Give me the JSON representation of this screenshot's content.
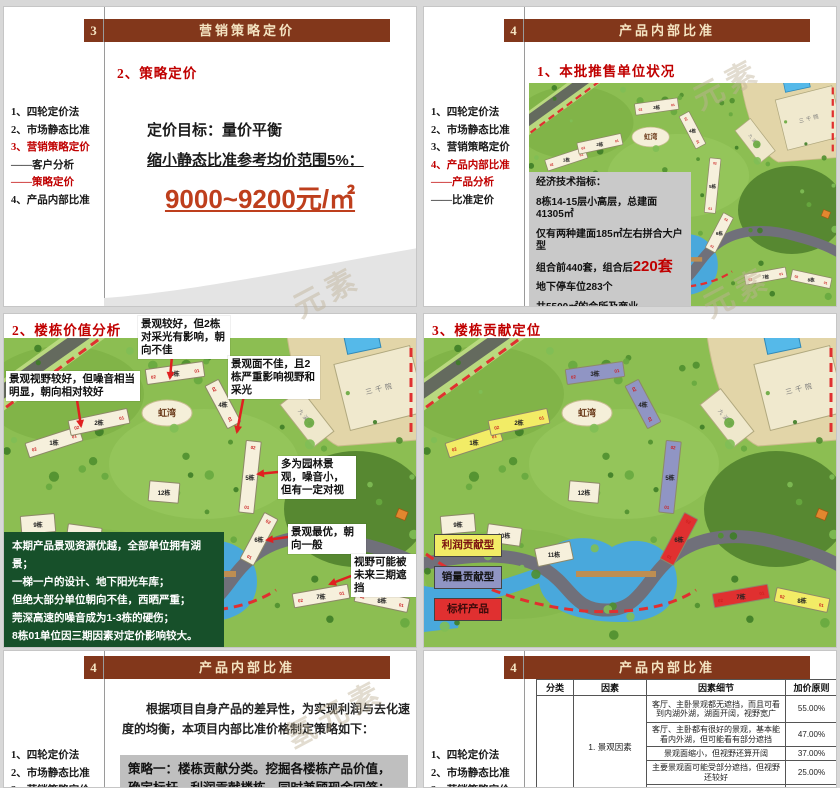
{
  "watermarks": [
    {
      "text": "元素",
      "x": 290,
      "y": 268
    },
    {
      "text": "元素",
      "x": 700,
      "y": 268
    },
    {
      "text": "氢元素",
      "x": 280,
      "y": 690
    },
    {
      "text": "元素",
      "x": 690,
      "y": 60
    }
  ],
  "s1": {
    "num": "3",
    "header": "营销策略定价",
    "nav": [
      {
        "label": "1、四轮定价法",
        "red": false
      },
      {
        "label": "2、市场静态比准",
        "red": false
      },
      {
        "label": "3、营销策略定价",
        "red": true
      },
      {
        "label": "——客户分析",
        "red": false
      },
      {
        "label": "——策略定价",
        "red": true
      },
      {
        "label": "4、产品内部比准",
        "red": false
      }
    ],
    "section": "2、策略定价",
    "goal_line": "定价目标：量价平衡",
    "range_line": "缩小静态比准参考均价范围5%：",
    "price": "9000~9200元/㎡",
    "page": "38"
  },
  "s2": {
    "num": "4",
    "header": "产品内部比准",
    "nav": [
      {
        "label": "1、四轮定价法",
        "red": false
      },
      {
        "label": "2、市场静态比准",
        "red": false
      },
      {
        "label": "3、营销策略定价",
        "red": false
      },
      {
        "label": "4、产品内部比准",
        "red": true
      },
      {
        "label": "——产品分析",
        "red": true
      },
      {
        "label": "——比准定价",
        "red": false
      }
    ],
    "section": "1、本批推售单位状况",
    "infobox": [
      "经济技术指标：",
      "8栋14-15层小高层，总建面41305㎡",
      "仅有两种建面185㎡左右拼合大户型",
      [
        "组合前440套，组合后",
        "220套"
      ],
      "地下停车位283个",
      "共5500㎡的会所及商业"
    ]
  },
  "s3": {
    "title": "2、楼栋价值分析",
    "callouts": [
      {
        "text": "景观较好，但2栋对采光有影响，朝向不佳",
        "x": 134,
        "y": 2,
        "w": 86
      },
      {
        "text": "景观面不佳，且2栋严重影响视野和采光",
        "x": 224,
        "y": 42,
        "w": 86
      },
      {
        "text": "景观视野较好，但噪音相当明显，朝向相对较好",
        "x": 2,
        "y": 57,
        "w": 128
      },
      {
        "text": "多为园林景观，噪音小，但有一定对视",
        "x": 274,
        "y": 142,
        "w": 72
      },
      {
        "text": "景观最优，朝向一般",
        "x": 284,
        "y": 210,
        "w": 72
      },
      {
        "text": "视野可能被未来三期遮挡",
        "x": 347,
        "y": 240,
        "w": 62
      }
    ],
    "arrows": [
      {
        "x1": 168,
        "y1": 42,
        "x2": 166,
        "y2": 64
      },
      {
        "x1": 240,
        "y1": 81,
        "x2": 233,
        "y2": 118
      },
      {
        "x1": 73,
        "y1": 86,
        "x2": 77,
        "y2": 112
      },
      {
        "x1": 274,
        "y1": 158,
        "x2": 254,
        "y2": 160
      },
      {
        "x1": 284,
        "y1": 223,
        "x2": 263,
        "y2": 226
      },
      {
        "x1": 347,
        "y1": 262,
        "x2": 326,
        "y2": 270
      }
    ],
    "greenbox": [
      "本期产品景观资源优越，全部单位拥有湖景；",
      "一梯一户的设计、地下阳光车库；",
      "但绝大部分单位朝向不佳，西晒严重；",
      "莞深高速的噪音成为1-3栋的硬伤；",
      "8栋01单位因三期因素对定价影响较大。"
    ]
  },
  "s4": {
    "title": "3、楼栋贡献定位",
    "legend": [
      {
        "label": "利润贡献型",
        "color": "#f2ec66",
        "text": "#7a1010",
        "y": 220
      },
      {
        "label": "销量贡献型",
        "color": "#9095c4",
        "text": "#111111",
        "y": 252
      },
      {
        "label": "标杆产品",
        "color": "#e03030",
        "text": "#3a0a0a",
        "y": 284
      }
    ]
  },
  "s5": {
    "num": "4",
    "header": "产品内部比准",
    "nav": [
      {
        "label": "1、四轮定价法",
        "red": false
      },
      {
        "label": "2、市场静态比准",
        "red": false
      },
      {
        "label": "3、营销策略定价",
        "red": false
      }
    ],
    "para": "根据项目自身产品的差异性，为实现利润与去化速度的均衡，本项目内部比准价格制定策略如下：",
    "strategy": "策略一：楼栋贡献分类。挖掘各楼栋产品价值，确定标杆、利润贡献楼栋，同时兼顾现金回笼；"
  },
  "s6": {
    "num": "4",
    "header": "产品内部比准",
    "nav": [
      {
        "label": "1、四轮定价法",
        "red": false
      },
      {
        "label": "2、市场静态比准",
        "red": false
      },
      {
        "label": "3、营销策略定价",
        "red": false
      }
    ],
    "table": {
      "headers": [
        "分类",
        "因素",
        "因素细节",
        "加价原则"
      ],
      "col_widths": [
        37,
        73,
        139,
        52
      ],
      "factor": "1. 景观因素",
      "row_heights": [
        27,
        24,
        14,
        24,
        16
      ],
      "rows": [
        [
          "客厅、主卧景观都无遮挡，而且可看到内湖外湖，湖面开阔，视野宽广",
          "55.00%"
        ],
        [
          "客厅、主卧都有很好的景观，基本能看内外湖，但可能看有部分遮挡",
          "47.00%"
        ],
        [
          "景观面缩小，但视野还算开阔",
          "37.00%"
        ],
        [
          "主要景观面可能受部分遮挡，但视野还较好",
          "25.00%"
        ],
        [
          "视野较好，但湖景为远景",
          "18.00%"
        ]
      ]
    }
  },
  "site_map": {
    "labels": {
      "lake_area": "虹湾",
      "grand_hall": "三千院",
      "pavilion": "九溪亭"
    },
    "unit_left": "02",
    "unit_right": "01",
    "group_colors": {
      "y": "#f2ec66",
      "p": "#9095c4",
      "r": "#e03030",
      "n": "#f6f0dc"
    },
    "buildings": [
      {
        "label": "1栋",
        "x": 50,
        "y": 128,
        "w": 56,
        "h": 15,
        "r": -18,
        "grp": "y"
      },
      {
        "label": "2栋",
        "x": 95,
        "y": 108,
        "w": 60,
        "h": 15,
        "r": -12,
        "grp": "y"
      },
      {
        "label": "3栋",
        "x": 171,
        "y": 59,
        "w": 58,
        "h": 15,
        "r": -8,
        "grp": "p"
      },
      {
        "label": "4栋",
        "x": 219,
        "y": 90,
        "w": 48,
        "h": 15,
        "r": 62,
        "grp": "p"
      },
      {
        "label": "5栋",
        "x": 246,
        "y": 163,
        "w": 15,
        "h": 72,
        "r": 6,
        "grp": "p"
      },
      {
        "label": "6栋",
        "x": 255,
        "y": 225,
        "w": 15,
        "h": 52,
        "r": 28,
        "grp": "r"
      },
      {
        "label": "7栋",
        "x": 317,
        "y": 282,
        "w": 56,
        "h": 14,
        "r": -10,
        "grp": "r"
      },
      {
        "label": "8栋",
        "x": 378,
        "y": 286,
        "w": 54,
        "h": 14,
        "r": 12,
        "grp": "y"
      },
      {
        "label": "9栋",
        "x": 34,
        "y": 210,
        "w": 34,
        "h": 18,
        "r": -5,
        "grp": "n"
      },
      {
        "label": "10栋",
        "x": 80,
        "y": 221,
        "w": 34,
        "h": 18,
        "r": 8,
        "grp": "n"
      },
      {
        "label": "11栋",
        "x": 130,
        "y": 240,
        "w": 36,
        "h": 18,
        "r": -12,
        "grp": "n"
      },
      {
        "label": "12栋",
        "x": 160,
        "y": 178,
        "w": 30,
        "h": 20,
        "r": 5,
        "grp": "n"
      }
    ]
  }
}
